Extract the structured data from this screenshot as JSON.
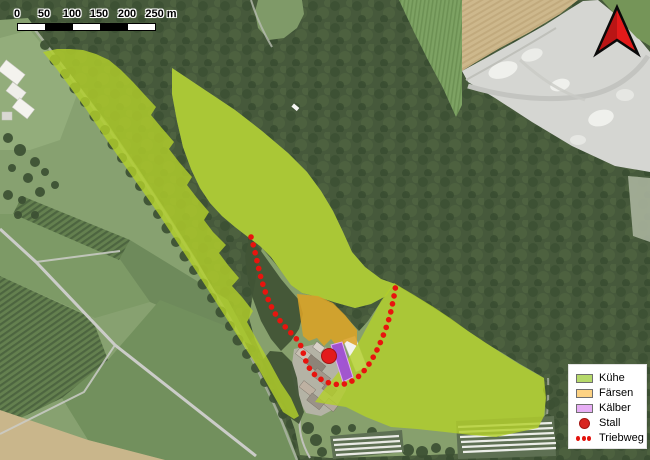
{
  "map": {
    "scale_bar": {
      "labels": [
        "0",
        "50",
        "100",
        "150",
        "200",
        "250 m"
      ]
    }
  },
  "legend": {
    "items": [
      {
        "label": "Kühe",
        "color": "#b6d96a"
      },
      {
        "label": "Färsen",
        "color": "#fdd283"
      },
      {
        "label": "Kälber",
        "color": "#e7aef5"
      },
      {
        "label": "Stall",
        "color": "#d8251f"
      },
      {
        "label": "Triebweg",
        "color": "#e3140e"
      }
    ]
  },
  "colors": {
    "kuehe_overlay": "#b2cf2b",
    "faersen_overlay": "#dba226",
    "kaelber_overlay": "#a14fd6",
    "stall": "#e31a1c",
    "triebweg": "#e8140e",
    "north_arrow": "#e31a1a"
  }
}
